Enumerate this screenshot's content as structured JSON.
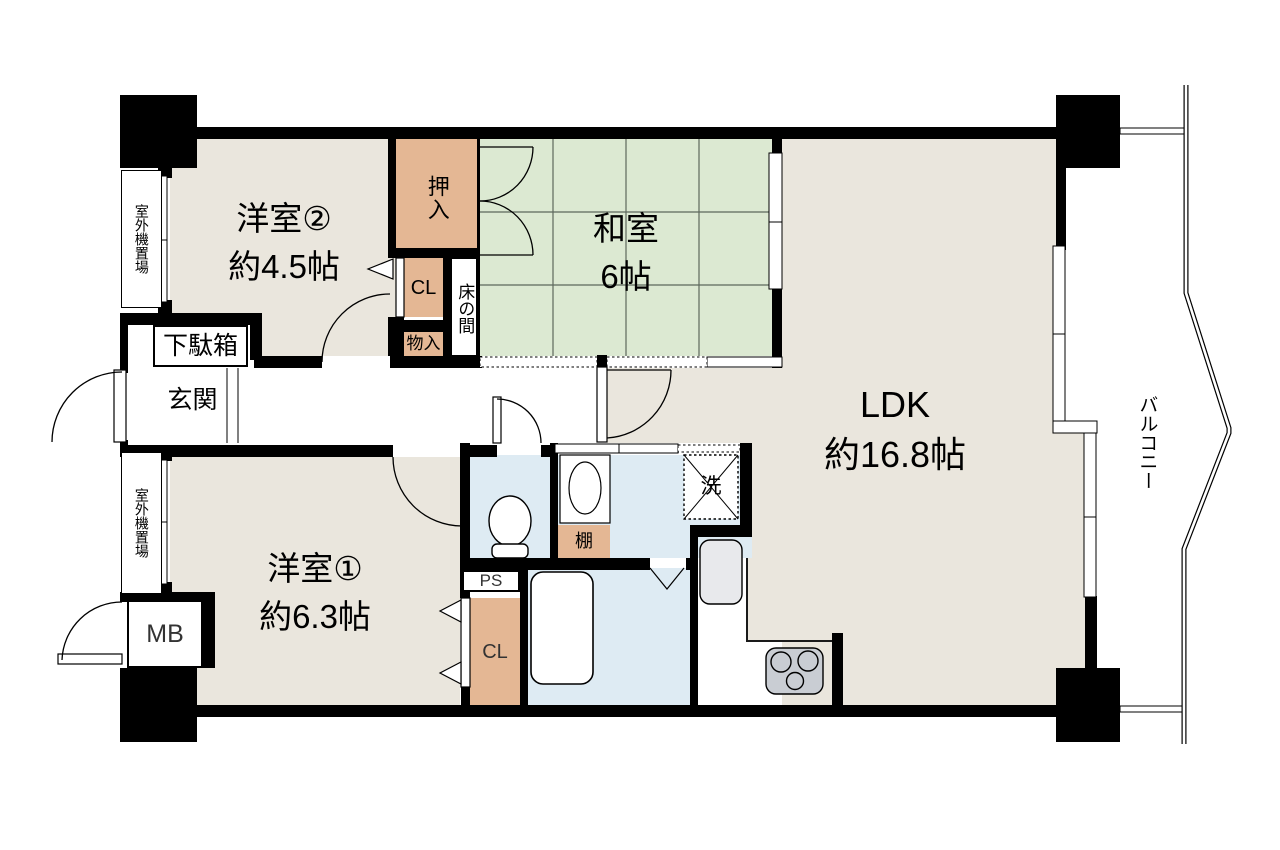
{
  "rooms": {
    "western2": {
      "name": "洋室②",
      "size": "約4.5帖"
    },
    "japanese": {
      "name": "和室",
      "size": "6帖"
    },
    "ldk": {
      "name": "LDK",
      "size": "約16.8帖"
    },
    "western1": {
      "name": "洋室①",
      "size": "約6.3帖"
    }
  },
  "labels": {
    "oshiire": "押入",
    "closet_upper": "CL",
    "storage": "物入",
    "tokonoma": "床の間",
    "shoe_cabinet": "下駄箱",
    "entrance": "玄関",
    "outdoor_unit_upper": "室外機置場",
    "outdoor_unit_lower": "室外機置場",
    "meter_box": "MB",
    "pipe_space": "PS",
    "closet_lower": "CL",
    "shelf": "棚",
    "laundry": "洗",
    "balcony": "バルコニー"
  },
  "colors": {
    "wall": "#000000",
    "room_floor": "#eae6dd",
    "tatami": "#dce9d2",
    "tatami_grid": "#5d685c",
    "closet": "#e4b794",
    "wet_area": "#deebf3",
    "fixture_gray": "#c9cdd3",
    "outline": "#1a1a1a"
  }
}
